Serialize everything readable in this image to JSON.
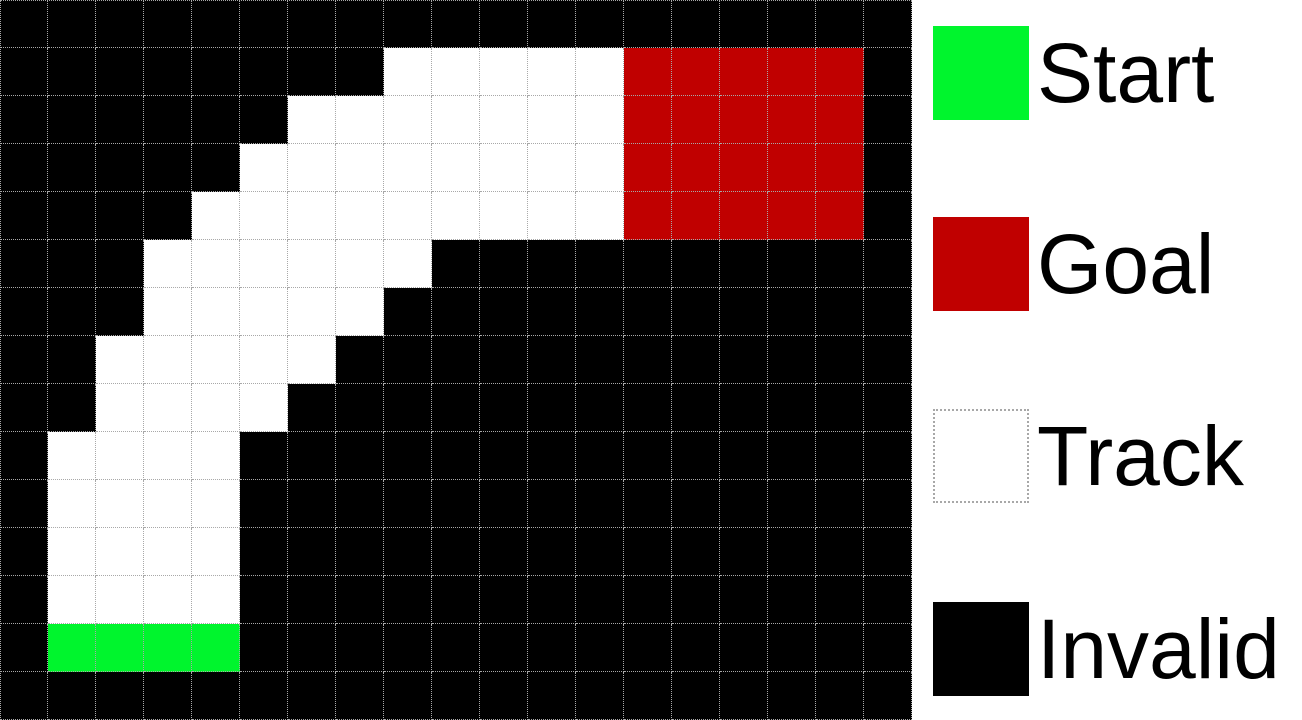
{
  "figure": {
    "type": "racetrack-grid-visualization"
  },
  "grid": {
    "rows": 15,
    "cols": 19,
    "cell_size_px": 48,
    "cell_codes": {
      ".": "invalid",
      "T": "track",
      "S": "start",
      "G": "goal"
    },
    "rows_map": [
      "...................",
      "........TTTTTGGGGG.",
      "......TTTTTTTGGGGG.",
      ".....TTTTTTTTGGGGG.",
      "....TTTTTTTTTGGGGG.",
      "...TTTTTT..........",
      "...TTTTT...........",
      "..TTTTT............",
      "..TTTT.............",
      ".TTTT..............",
      ".TTTT..............",
      ".TTTT..............",
      ".TTTT..............",
      ".SSSS..............",
      "..................."
    ]
  },
  "colors": {
    "start": "#00F52D",
    "goal": "#C00000",
    "track": "#FFFFFF",
    "invalid": "#000000",
    "gridline": "#A8A8A8",
    "legend_bg": "#FFFFFF",
    "label_text": "#000000"
  },
  "legend": {
    "items": [
      {
        "label": "Start",
        "color": "#00F52D",
        "bordered": false
      },
      {
        "label": "Goal",
        "color": "#C00000",
        "bordered": false
      },
      {
        "label": "Track",
        "color": "#FFFFFF",
        "bordered": true
      },
      {
        "label": "Invalid",
        "color": "#000000",
        "bordered": false
      }
    ]
  }
}
